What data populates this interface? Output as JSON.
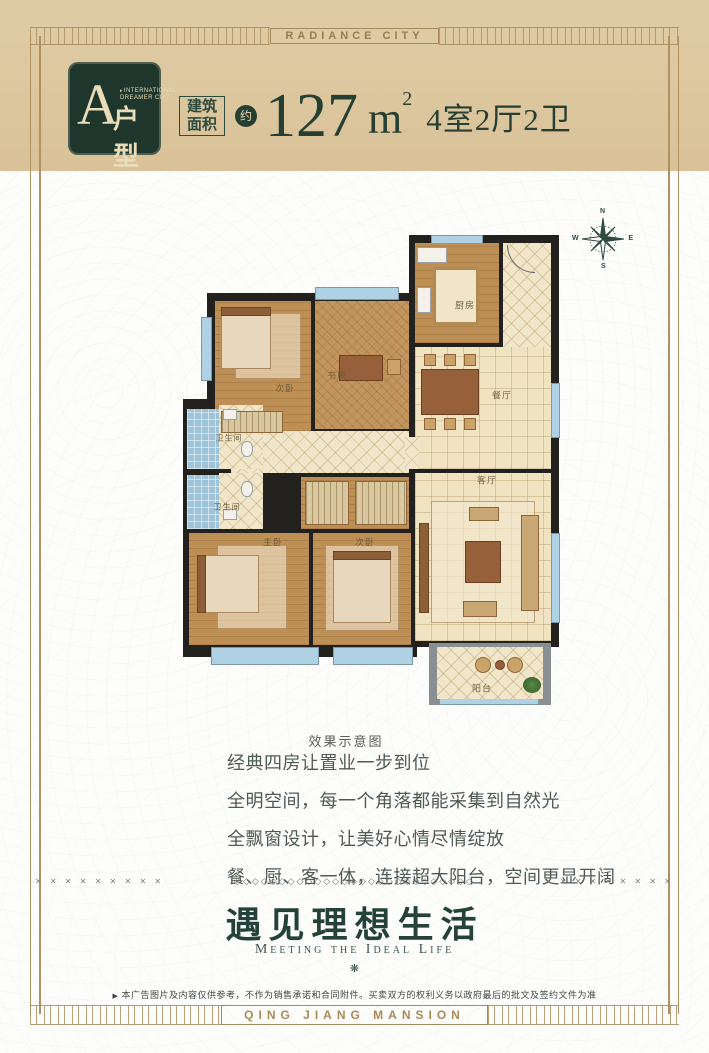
{
  "banners": {
    "top": "RADIANCE CITY",
    "bottom": "QING JIANG MANSION"
  },
  "header": {
    "badge": {
      "letter": "A",
      "brand_marker": "▸",
      "brand_line1": "INTERNATIONAL",
      "brand_line2": "DREAMER CITY",
      "type_label": "户型"
    },
    "area_box_line1": "建筑",
    "area_box_line2": "面积",
    "approx": "约",
    "area_value": "127",
    "area_unit": "m",
    "area_sup": "2",
    "layout_text": "4室2厅2卫"
  },
  "compass": {
    "n": "N",
    "e": "E",
    "s": "S",
    "w": "W"
  },
  "floorplan": {
    "caption": "效果示意图",
    "rooms": {
      "kitchen": "厨房",
      "dining": "餐厅",
      "living": "客厅",
      "study": "书房",
      "bedroom_top": "次卧",
      "master": "主卧",
      "bedroom_second": "次卧",
      "bath_upper": "卫生间",
      "bath_lower": "卫生间",
      "balcony": "阳台"
    }
  },
  "features": {
    "lines": [
      "经典四房让置业一步到位",
      "全明空间，每一个角落都能采集到自然光",
      "全飘窗设计，让美好心情尽情绽放",
      "餐、厨、客一体，连接超大阳台，空间更显开阔"
    ]
  },
  "divider": {
    "left_xs": "✕ ✕ ✕ ✕ ✕ ✕ ✕ ✕ ✕",
    "chain": "◇◇◇◇◇◇◇◇◇◇◇◇◇◈◇◇◇◇◇◇◇◇◇◇◇◇◇",
    "right_xs": "✕ ✕ ✕ ✕ ✕ ✕ ✕ ✕ ✕"
  },
  "slogan": {
    "title": "遇见理想生活",
    "subtitle": "Meeting the Ideal Life",
    "ornament": "❋"
  },
  "disclaimer": {
    "marker": "▶",
    "text": "本广告图片及内容仅供参考，不作为销售承诺和合同附件。买卖双方的权利义务以政府最后的批文及签约文件为准"
  },
  "colors": {
    "accent_green": "#1e362c",
    "frame_gold": "#a8895c",
    "header_beige": "#dcc69e",
    "wall_black": "#23211e",
    "wood_floor": "#bd8f55",
    "cream_tile": "#efe3c2",
    "window_blue": "#aed2e4"
  }
}
